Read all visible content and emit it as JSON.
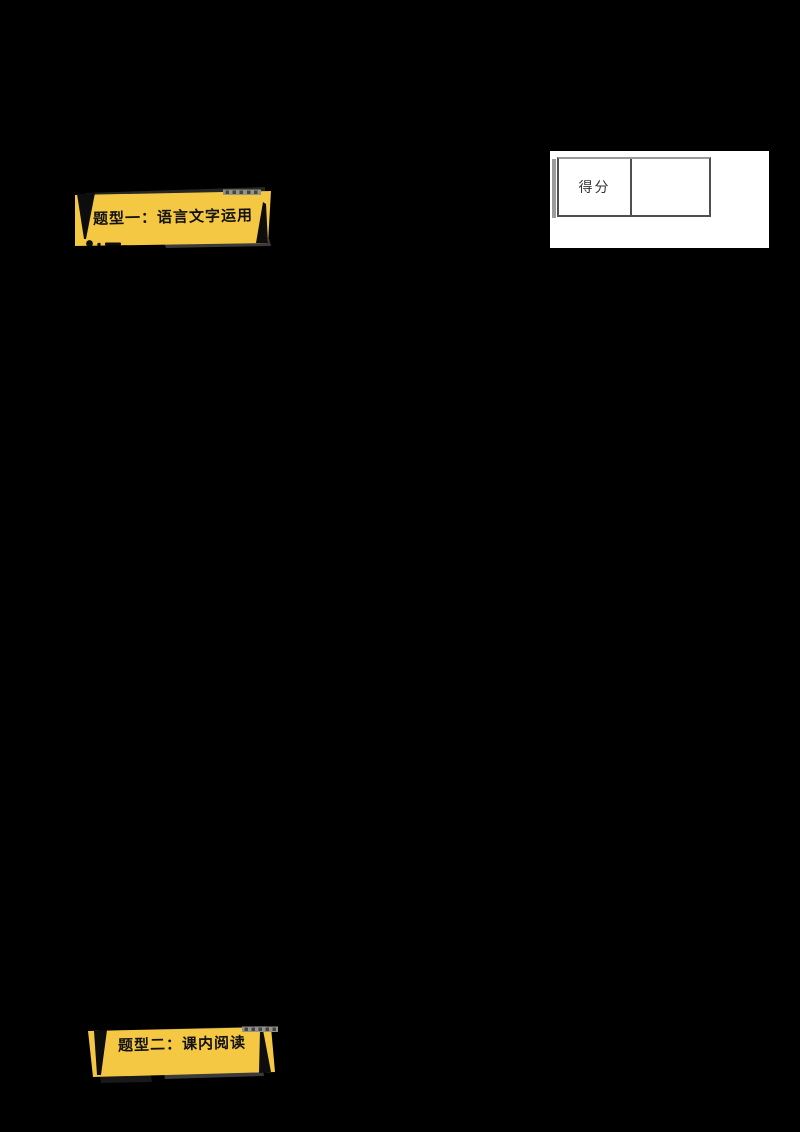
{
  "theme": {
    "page-bg": "#000000",
    "banner-yellow": "#F5C843",
    "banner-ink": "#0d0d0d",
    "banner-text": "#131313",
    "panel-bg": "#ffffff",
    "table-border": "#4f4f4f",
    "table-border-top": "#999999",
    "score-text": "#333333"
  },
  "banners": {
    "banner1": {
      "label": "题型一：语言文字运用"
    },
    "banner2": {
      "label": "题型二：课内阅读"
    }
  },
  "score_panel": {
    "label": "得分",
    "value": ""
  }
}
